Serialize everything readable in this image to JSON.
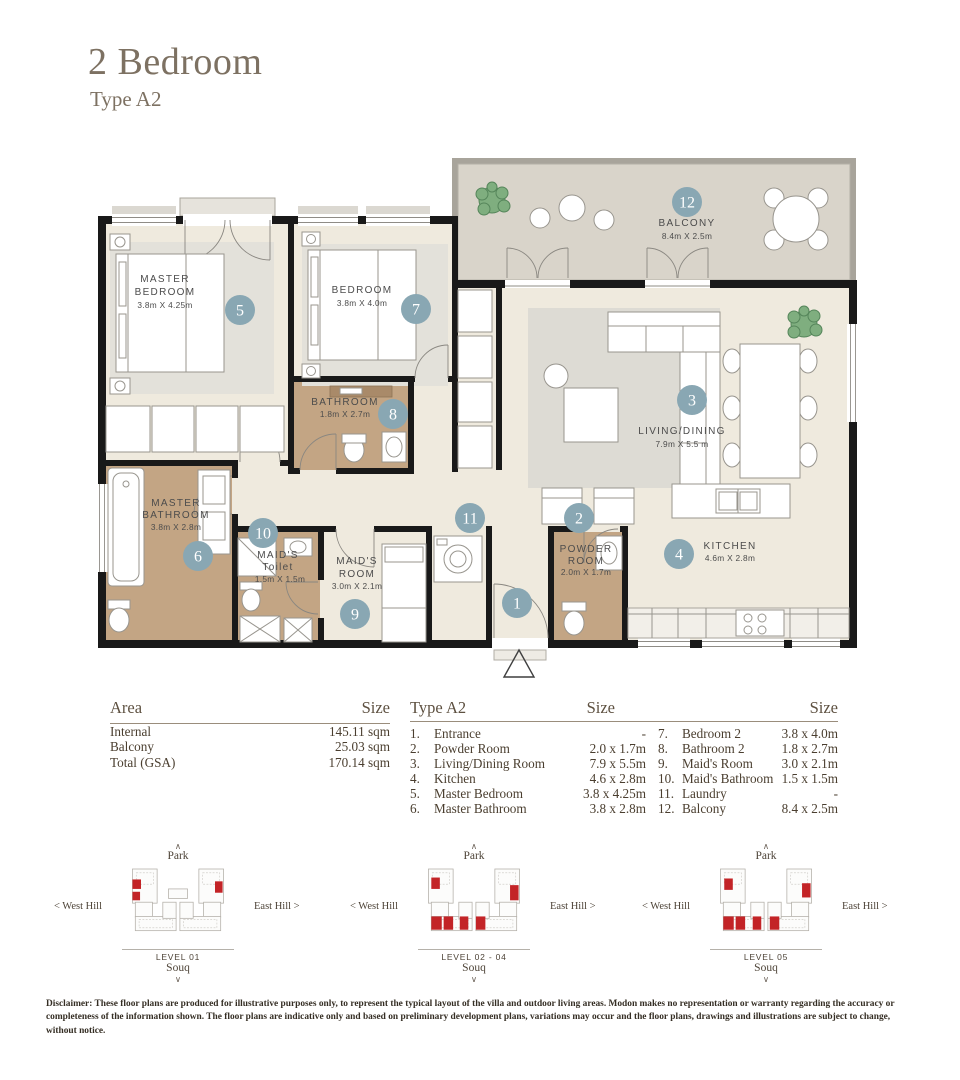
{
  "page": {
    "title": "2 Bedroom",
    "subtitle": "Type A2"
  },
  "plan": {
    "rooms": {
      "entrance": {
        "badge": "1"
      },
      "powder_room": {
        "badge": "2",
        "line1": "POWDER",
        "line2": "ROOM",
        "dims": "2.0m X 1.7m"
      },
      "living_dining": {
        "badge": "3",
        "line1": "LIVING/DINING",
        "dims": "7.9m X 5.5 m"
      },
      "kitchen": {
        "badge": "4",
        "line1": "KITCHEN",
        "dims": "4.6m X 2.8m"
      },
      "master_bedroom": {
        "badge": "5",
        "line1": "MASTER",
        "line2": "BEDROOM",
        "dims": "3.8m X 4.25m"
      },
      "master_bathroom": {
        "badge": "6",
        "line1": "MASTER",
        "line2": "BATHROOM",
        "dims": "3.8m X 2.8m"
      },
      "bedroom": {
        "badge": "7",
        "line1": "BEDROOM",
        "dims": "3.8m X 4.0m"
      },
      "bathroom": {
        "badge": "8",
        "line1": "BATHROOM",
        "dims": "1.8m X 2.7m"
      },
      "maids_room": {
        "badge": "9",
        "line1": "MAID'S",
        "line2": "ROOM",
        "dims": "3.0m X 2.1m"
      },
      "maids_toilet": {
        "badge": "10",
        "line1": "MAID'S",
        "line2": "Toilet",
        "dims": "1.5m X 1.5m"
      },
      "laundry": {
        "badge": "11"
      },
      "balcony": {
        "badge": "12",
        "line1": "BALCONY",
        "dims": "8.4m X 2.5m"
      }
    }
  },
  "area_table": {
    "col_label": "Area",
    "col_size": "Size",
    "rows": [
      {
        "label": "Internal",
        "size": "145.11 sqm"
      },
      {
        "label": "Balcony",
        "size": "25.03 sqm"
      },
      {
        "label": "Total (GSA)",
        "size": "170.14 sqm"
      }
    ]
  },
  "type_table": {
    "title": "Type A2",
    "size_header": "Size",
    "size_header2": "Size",
    "left": [
      {
        "no": "1.",
        "name": "Entrance",
        "size": "-"
      },
      {
        "no": "2.",
        "name": "Powder Room",
        "size": "2.0 x 1.7m"
      },
      {
        "no": "3.",
        "name": "Living/Dining Room",
        "size": "7.9 x 5.5m"
      },
      {
        "no": "4.",
        "name": "Kitchen",
        "size": "4.6 x 2.8m"
      },
      {
        "no": "5.",
        "name": "Master Bedroom",
        "size": "3.8 x 4.25m"
      },
      {
        "no": "6.",
        "name": "Master Bathroom",
        "size": "3.8 x 2.8m"
      }
    ],
    "right": [
      {
        "no": "7.",
        "name": "Bedroom 2",
        "size": "3.8 x 4.0m"
      },
      {
        "no": "8.",
        "name": "Bathroom 2",
        "size": "1.8 x 2.7m"
      },
      {
        "no": "9.",
        "name": "Maid's Room",
        "size": "3.0 x 2.1m"
      },
      {
        "no": "10.",
        "name": "Maid's Bathroom",
        "size": "1.5 x 1.5m"
      },
      {
        "no": "11.",
        "name": "Laundry",
        "size": "-"
      },
      {
        "no": "12.",
        "name": "Balcony",
        "size": "8.4 x 2.5m"
      }
    ]
  },
  "diagrams": {
    "park": "Park",
    "west": "West Hill",
    "east": "East Hill",
    "souq": "Souq",
    "chevron_up": "∧",
    "chevron_down": "∨",
    "chevron_left": "<",
    "chevron_right": ">",
    "levels": [
      "LEVEL 01",
      "LEVEL 02 - 04",
      "LEVEL 05"
    ]
  },
  "disclaimer": "Disclaimer: These floor plans are produced for illustrative purposes only, to represent the typical layout of the villa and outdoor living areas. Modon makes no representation or warranty regarding the accuracy or completeness of the information shown. The floor plans are indicative only and based on preliminary development plans, variations may occur and the floor plans, drawings and illustrations are subject to change, without notice.",
  "colors": {
    "title": "#7d7162",
    "badge": "#89a7b3",
    "wall": "#191919",
    "wet_area": "#c3a584",
    "balcony_floor": "#d9d4ca",
    "unit_highlight": "#c32427"
  }
}
